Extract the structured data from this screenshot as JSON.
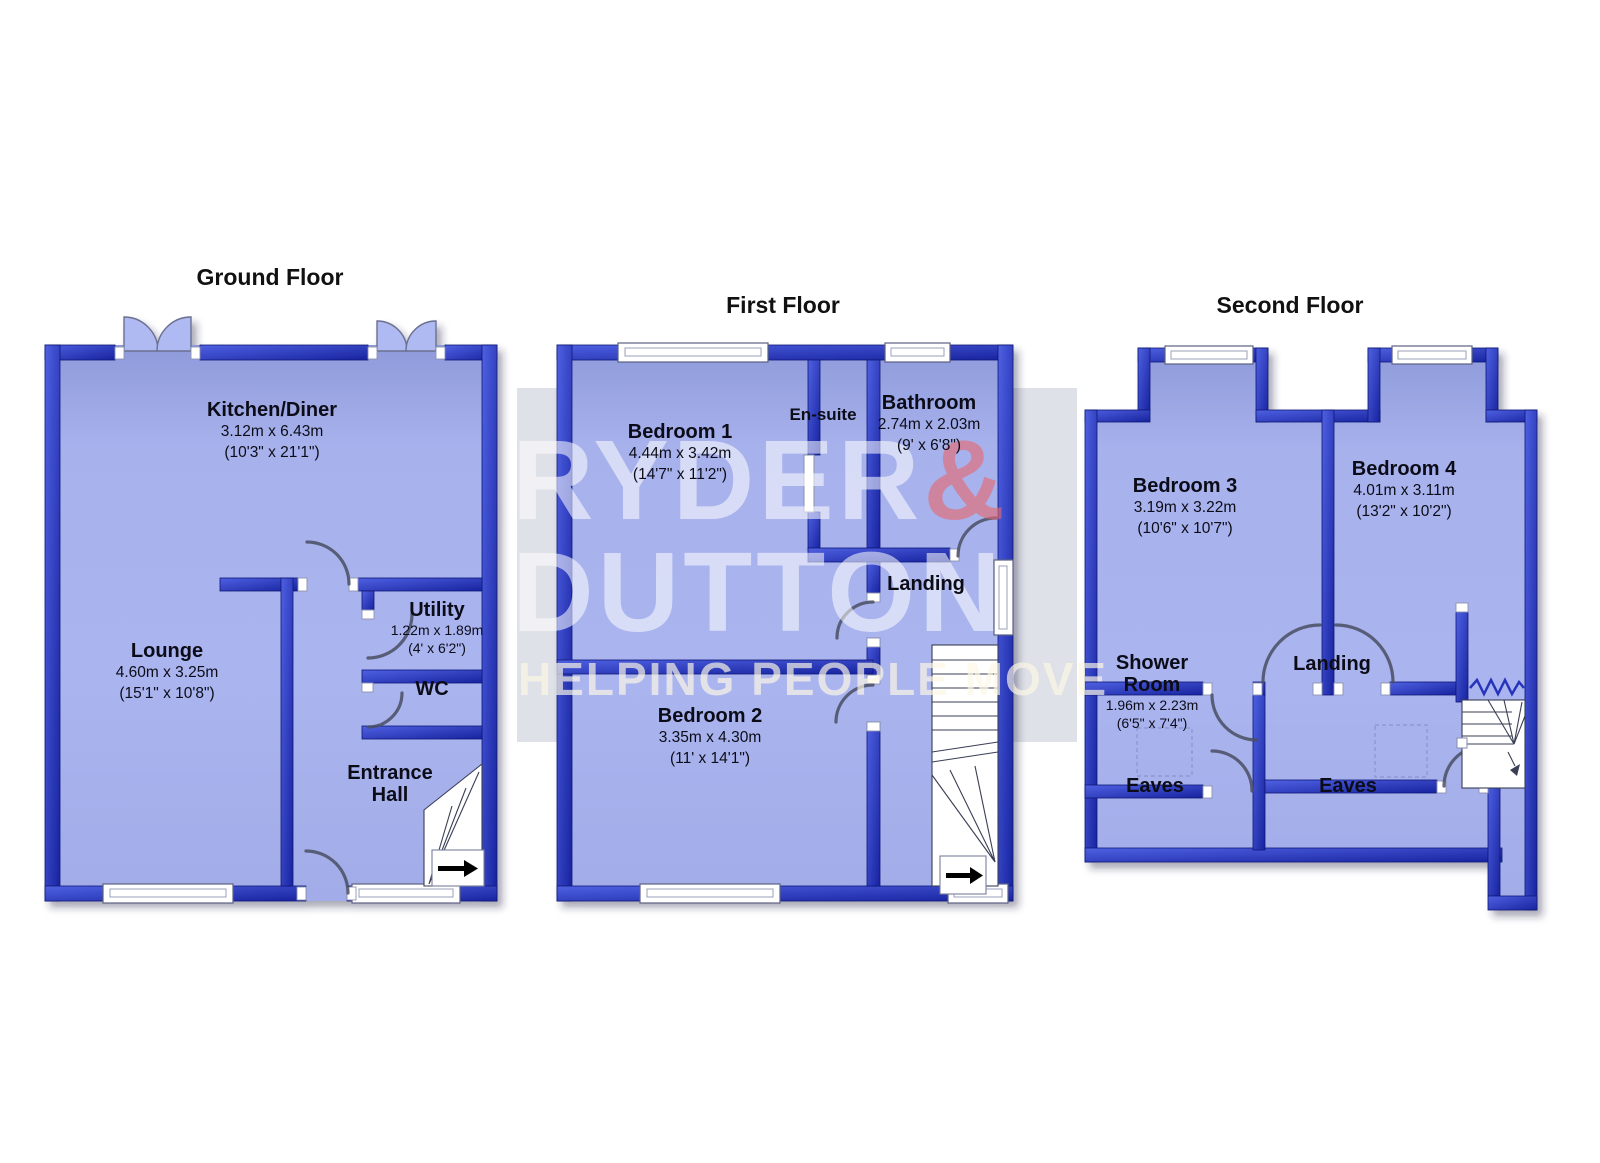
{
  "watermark": {
    "brand_name": "RYDER",
    "brand_amp": "&",
    "brand_line2": "DUTTON",
    "tagline": "HELPING PEOPLE MOVE",
    "accent_color": "#e7686e",
    "box_color": "#dfe1e8"
  },
  "palette": {
    "wall_blue": "#2b3cd0",
    "floor_lilac": "#aab4ee",
    "label_color": "#0c0c18"
  },
  "floors": [
    {
      "title": "Ground Floor",
      "rooms": [
        {
          "name": "Kitchen/Diner",
          "dim_m": "3.12m x 6.43m",
          "dim_i": "(10'3\" x 21'1\")"
        },
        {
          "name": "Lounge",
          "dim_m": "4.60m x 3.25m",
          "dim_i": "(15'1\" x 10'8\")"
        },
        {
          "name": "Utility",
          "dim_m": "1.22m x 1.89m",
          "dim_i": "(4' x 6'2\")"
        },
        {
          "name": "WC"
        },
        {
          "name": "Entrance Hall"
        }
      ]
    },
    {
      "title": "First Floor",
      "rooms": [
        {
          "name": "Bedroom 1",
          "dim_m": "4.44m x 3.42m",
          "dim_i": "(14'7\" x 11'2\")"
        },
        {
          "name": "En-suite"
        },
        {
          "name": "Bathroom",
          "dim_m": "2.74m x 2.03m",
          "dim_i": "(9' x 6'8\")"
        },
        {
          "name": "Landing"
        },
        {
          "name": "Bedroom 2",
          "dim_m": "3.35m x 4.30m",
          "dim_i": "(11' x 14'1\")"
        }
      ]
    },
    {
      "title": "Second Floor",
      "rooms": [
        {
          "name": "Bedroom 3",
          "dim_m": "3.19m x 3.22m",
          "dim_i": "(10'6\" x 10'7\")"
        },
        {
          "name": "Bedroom 4",
          "dim_m": "4.01m x 3.11m",
          "dim_i": "(13'2\" x 10'2\")"
        },
        {
          "name": "Shower Room",
          "dim_m": "1.96m x 2.23m",
          "dim_i": "(6'5\" x 7'4\")"
        },
        {
          "name": "Landing"
        },
        {
          "name": "Eaves"
        },
        {
          "name": "Eaves"
        }
      ]
    }
  ]
}
